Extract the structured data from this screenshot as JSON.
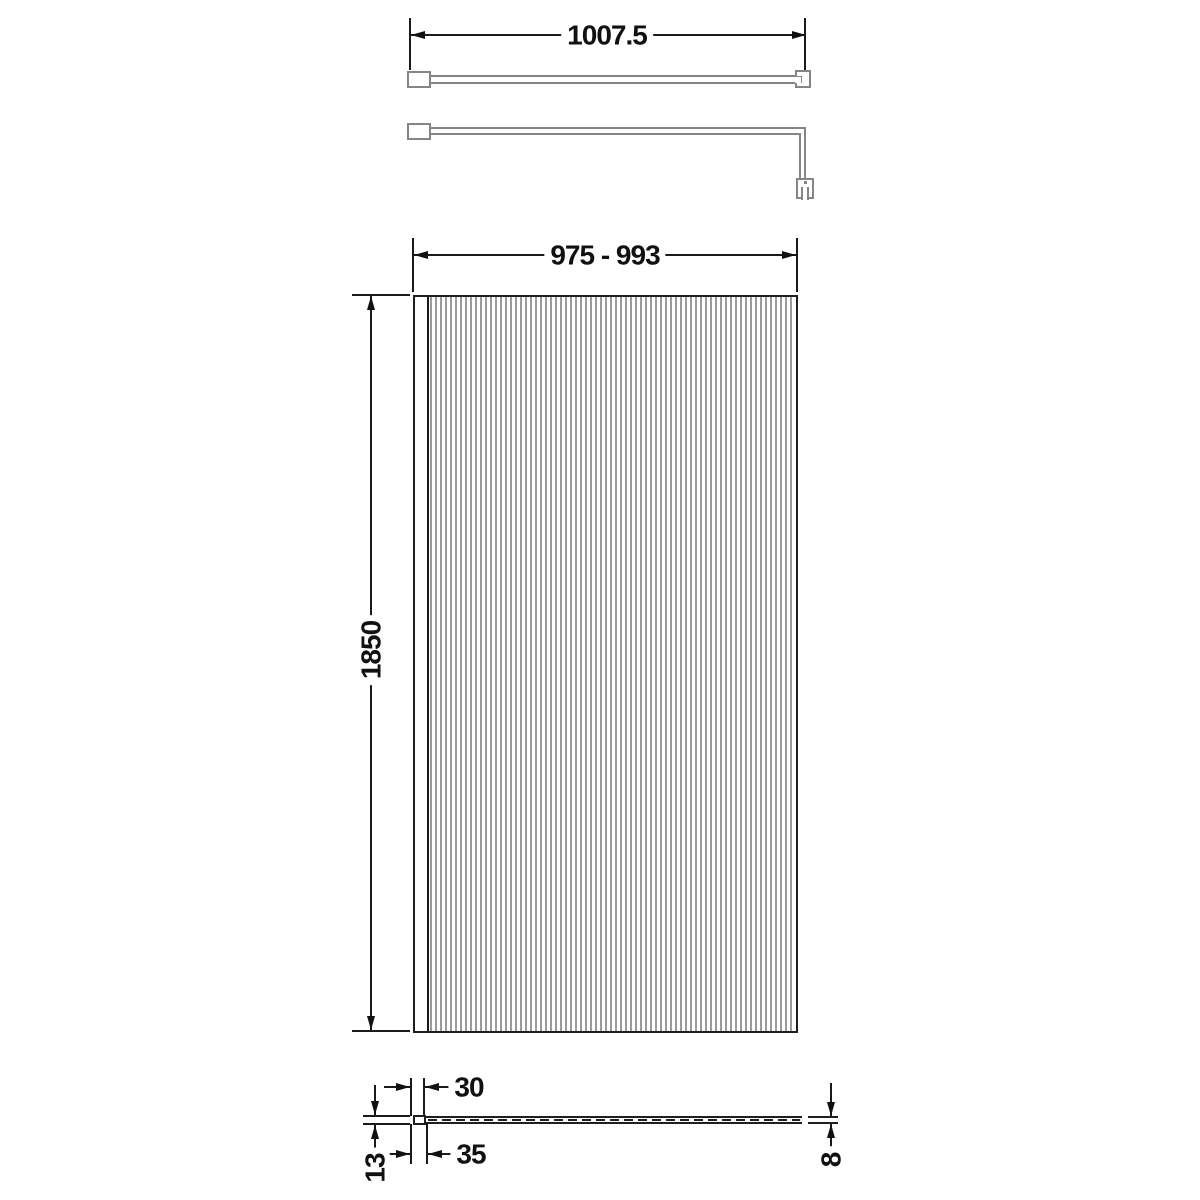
{
  "dimensions": {
    "arm_length": "1007.5",
    "panel_width_range": "975 - 993",
    "panel_height": "1850",
    "profile_width_top": "30",
    "profile_width_bottom": "35",
    "profile_depth": "13",
    "glass_thickness": "8"
  },
  "colors": {
    "line": "#1a1a1a",
    "hardware": "#858585",
    "flute": "#9a9a9a",
    "background": "#ffffff"
  }
}
